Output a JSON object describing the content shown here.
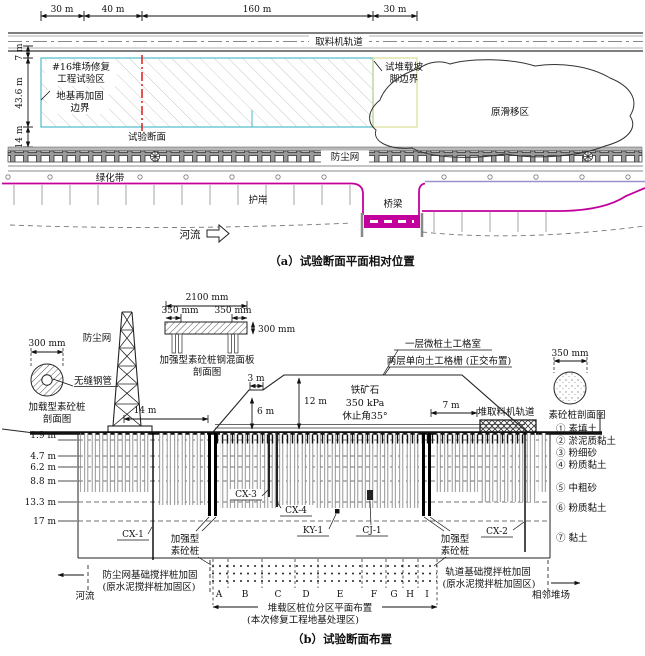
{
  "figure_a": {
    "top_dims": [
      "30 m",
      "40 m",
      "160 m",
      "30 m"
    ],
    "left_dims": [
      "7 m",
      "43.6 m",
      "14 m"
    ],
    "track_label": "取料机轨道",
    "test_zone_line1": "#16堆场修复",
    "test_zone_line2": "工程试验区",
    "reinforce_boundary_line1": "地基再加固",
    "reinforce_boundary_line2": "边界",
    "test_section_label": "试验断面",
    "slope_toe_line1": "试堆载坡",
    "slope_toe_line2": "脚边界",
    "slip_zone_label": "原滑移区",
    "dust_net_label": "防尘网",
    "green_belt_label": "绿化带",
    "revetment_label": "护岸",
    "bridge_label": "桥梁",
    "river_label": "河流",
    "caption": "（a）试验断面平面相对位置"
  },
  "figure_b": {
    "loading_pile_detail": {
      "dim": "300 mm",
      "pipe_label": "无缝钢管",
      "title_line1": "加载型素砼桩",
      "title_line2": "剖面图"
    },
    "dust_net_label": "防尘网",
    "panel_detail": {
      "dim_total": "2100 mm",
      "dim_left": "350 mm",
      "dim_right": "350 mm",
      "dim_thickness": "300 mm",
      "title_line1": "加强型素砼桩钢混面板",
      "title_line2": "剖面图"
    },
    "geocell_label": "一层微桩土工格室",
    "geogrid_label": "两层单向土工格栅 (正交布置)",
    "plain_pile_detail": {
      "dim": "350 mm",
      "title": "素砼桩剖面图"
    },
    "track_label": "堆取料机轨道",
    "ore": {
      "line1": "铁矿石",
      "line2": "350 kPa",
      "line3": "休止角35°"
    },
    "dims": {
      "bench": "3 m",
      "height_total": "12 m",
      "height_lower": "6 m",
      "left_offset": "14 m",
      "right_offset": "7 m"
    },
    "depths": [
      "1.9 m",
      "4.7 m",
      "6.2 m",
      "8.8 m",
      "13.3 m",
      "17 m"
    ],
    "soil_layers": [
      "① 素填土",
      "② 淤泥质黏土",
      "③ 粉细砂",
      "④ 粉质黏土",
      "⑤ 中粗砂",
      "⑥ 粉质黏土",
      "⑦ 黏土"
    ],
    "instruments": {
      "cx1": "CX-1",
      "cx2": "CX-2",
      "cx3": "CX-3",
      "cx4": "CX-4",
      "ky1": "KY-1",
      "cj1": "CJ-1"
    },
    "strong_pile_line1": "加强型",
    "strong_pile_line2": "素砼桩",
    "bottom_left_line1": "防尘网基础搅拌桩加固",
    "bottom_left_line2": "(原水泥搅拌桩加固区)",
    "river_label": "河流",
    "zone_letters": [
      "A",
      "B",
      "C",
      "D",
      "E",
      "F",
      "G",
      "H",
      "I"
    ],
    "plan_line1": "堆载区桩位分区平面布置",
    "plan_line2": "(本次修复工程地基处理区)",
    "bottom_right_line1": "轨道基础搅拌桩加固",
    "bottom_right_line2": "(原水泥搅拌桩加固区)",
    "adjacent_label": "相邻堆场",
    "caption": "（b）试验断面布置"
  },
  "colors": {
    "magenta": "#c2019c",
    "cyan": "#68c6cf",
    "red": "#df2b26",
    "yellow_green": "#d8dc96",
    "purple": "#9a90cc"
  }
}
